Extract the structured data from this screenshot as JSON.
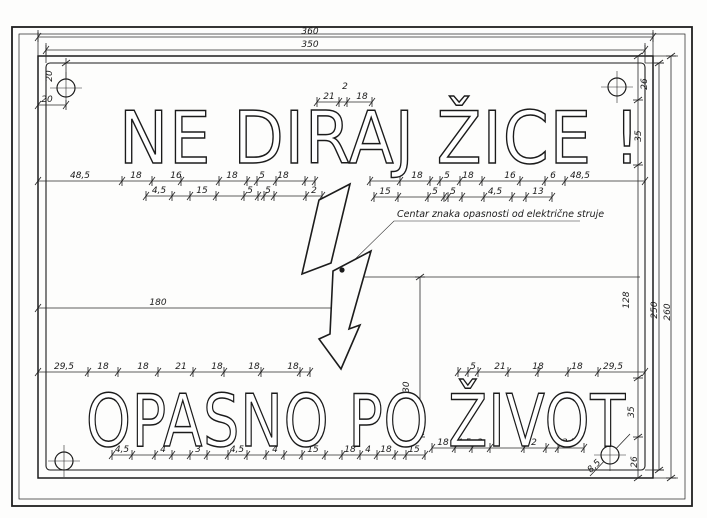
{
  "sign": {
    "line1": "NE DIRAJ ŽICE !",
    "line2": "OPASNO PO ŽIVOT"
  },
  "annotation": {
    "text": "Centar znaka opasnosti od električne struje"
  },
  "features": {
    "symbol": "lightning-bolt",
    "mounting_holes": 4
  },
  "colors": {
    "ink": "#1c1c1c",
    "paper": "#fdfdfc"
  },
  "dim_labels": [
    {
      "t": "360",
      "x": 310,
      "y": 34,
      "r": 0
    },
    {
      "t": "350",
      "x": 310,
      "y": 47,
      "r": 0
    },
    {
      "t": "20",
      "x": 52,
      "y": 76,
      "r": -90
    },
    {
      "t": "20",
      "x": 47,
      "y": 102,
      "r": 0
    },
    {
      "t": "26",
      "x": 647,
      "y": 84,
      "r": -90
    },
    {
      "t": "35",
      "x": 641,
      "y": 136,
      "r": -90
    },
    {
      "t": "21",
      "x": 329,
      "y": 99,
      "r": 0
    },
    {
      "t": "2",
      "x": 345,
      "y": 89,
      "r": 0
    },
    {
      "t": "18",
      "x": 362,
      "y": 99,
      "r": 0
    },
    {
      "t": "48,5",
      "x": 80,
      "y": 178,
      "r": 0
    },
    {
      "t": "18",
      "x": 136,
      "y": 178,
      "r": 0
    },
    {
      "t": "16",
      "x": 176,
      "y": 178,
      "r": 0
    },
    {
      "t": "18",
      "x": 232,
      "y": 178,
      "r": 0
    },
    {
      "t": "5",
      "x": 262,
      "y": 178,
      "r": 0
    },
    {
      "t": "18",
      "x": 283,
      "y": 178,
      "r": 0
    },
    {
      "t": "18",
      "x": 417,
      "y": 178,
      "r": 0
    },
    {
      "t": "5",
      "x": 447,
      "y": 178,
      "r": 0
    },
    {
      "t": "18",
      "x": 468,
      "y": 178,
      "r": 0
    },
    {
      "t": "16",
      "x": 510,
      "y": 178,
      "r": 0
    },
    {
      "t": "6",
      "x": 553,
      "y": 178,
      "r": 0
    },
    {
      "t": "48,5",
      "x": 580,
      "y": 178,
      "r": 0
    },
    {
      "t": "4,5",
      "x": 159,
      "y": 193,
      "r": 0
    },
    {
      "t": "15",
      "x": 202,
      "y": 193,
      "r": 0
    },
    {
      "t": "5",
      "x": 250,
      "y": 193,
      "r": 0
    },
    {
      "t": "5",
      "x": 268,
      "y": 193,
      "r": 0
    },
    {
      "t": "2",
      "x": 314,
      "y": 193,
      "r": 0
    },
    {
      "t": "15",
      "x": 385,
      "y": 194,
      "r": 0
    },
    {
      "t": "5",
      "x": 435,
      "y": 194,
      "r": 0
    },
    {
      "t": "5",
      "x": 453,
      "y": 194,
      "r": 0
    },
    {
      "t": "4,5",
      "x": 495,
      "y": 194,
      "r": 0
    },
    {
      "t": "13",
      "x": 538,
      "y": 194,
      "r": 0
    },
    {
      "t": "180",
      "x": 158,
      "y": 305,
      "r": 0
    },
    {
      "t": "130",
      "x": 409,
      "y": 390,
      "r": -90
    },
    {
      "t": "128",
      "x": 629,
      "y": 300,
      "r": -90
    },
    {
      "t": "250",
      "x": 657,
      "y": 310,
      "r": -90
    },
    {
      "t": "260",
      "x": 670,
      "y": 312,
      "r": -90
    },
    {
      "t": "29,5",
      "x": 64,
      "y": 369,
      "r": 0
    },
    {
      "t": "18",
      "x": 103,
      "y": 369,
      "r": 0
    },
    {
      "t": "18",
      "x": 143,
      "y": 369,
      "r": 0
    },
    {
      "t": "21",
      "x": 181,
      "y": 369,
      "r": 0
    },
    {
      "t": "18",
      "x": 217,
      "y": 369,
      "r": 0
    },
    {
      "t": "18",
      "x": 254,
      "y": 369,
      "r": 0
    },
    {
      "t": "18",
      "x": 293,
      "y": 369,
      "r": 0
    },
    {
      "t": "5",
      "x": 473,
      "y": 369,
      "r": 0
    },
    {
      "t": "21",
      "x": 500,
      "y": 369,
      "r": 0
    },
    {
      "t": "18",
      "x": 538,
      "y": 369,
      "r": 0
    },
    {
      "t": "18",
      "x": 577,
      "y": 369,
      "r": 0
    },
    {
      "t": "29,5",
      "x": 613,
      "y": 369,
      "r": 0
    },
    {
      "t": "4,5",
      "x": 122,
      "y": 452,
      "r": 0
    },
    {
      "t": "4",
      "x": 163,
      "y": 452,
      "r": 0
    },
    {
      "t": "3",
      "x": 198,
      "y": 452,
      "r": 0
    },
    {
      "t": "4,5",
      "x": 237,
      "y": 452,
      "r": 0
    },
    {
      "t": "4",
      "x": 275,
      "y": 452,
      "r": 0
    },
    {
      "t": "15",
      "x": 313,
      "y": 452,
      "r": 0
    },
    {
      "t": "18",
      "x": 350,
      "y": 452,
      "r": 0
    },
    {
      "t": "4",
      "x": 368,
      "y": 452,
      "r": 0
    },
    {
      "t": "18",
      "x": 386,
      "y": 452,
      "r": 0
    },
    {
      "t": "15",
      "x": 414,
      "y": 452,
      "r": 0
    },
    {
      "t": "18",
      "x": 443,
      "y": 445,
      "r": 0
    },
    {
      "t": "4,5",
      "x": 464,
      "y": 445,
      "r": 0
    },
    {
      "t": "3",
      "x": 480,
      "y": 445,
      "r": 0
    },
    {
      "t": "2",
      "x": 534,
      "y": 445,
      "r": 0
    },
    {
      "t": "3,5",
      "x": 569,
      "y": 445,
      "r": 0
    },
    {
      "t": "8,5",
      "x": 596,
      "y": 468,
      "r": -45
    },
    {
      "t": "26",
      "x": 637,
      "y": 462,
      "r": -90
    },
    {
      "t": "35",
      "x": 634,
      "y": 412,
      "r": -90
    }
  ],
  "ticks": {
    "h": [
      {
        "y": 37,
        "xs": [
          38,
          653
        ]
      },
      {
        "y": 50,
        "xs": [
          46,
          645
        ]
      },
      {
        "y": 102,
        "xs": [
          317,
          339,
          347,
          372
        ]
      },
      {
        "y": 105,
        "xs": [
          38,
          66
        ]
      },
      {
        "y": 181,
        "xs": [
          38,
          122,
          152,
          181,
          219,
          247,
          257,
          276,
          305,
          315,
          370,
          400,
          430,
          440,
          460,
          482,
          520,
          545,
          565,
          645
        ]
      },
      {
        "y": 196,
        "xs": [
          146,
          172,
          190,
          216,
          244,
          258,
          264,
          274,
          306,
          322
        ]
      },
      {
        "y": 197,
        "xs": [
          374,
          398,
          428,
          444,
          448,
          462,
          484,
          512,
          526,
          552
        ]
      },
      {
        "y": 308,
        "xs": [
          38,
          343
        ]
      },
      {
        "y": 372,
        "xs": [
          38,
          88,
          118,
          158,
          193,
          224,
          261,
          300,
          310,
          458,
          468,
          478,
          508,
          538,
          568,
          598,
          645
        ]
      },
      {
        "y": 455,
        "xs": [
          112,
          132,
          155,
          172,
          190,
          207,
          228,
          247,
          266,
          284,
          302,
          325,
          342,
          360,
          377,
          395,
          406,
          425
        ]
      },
      {
        "y": 448,
        "xs": [
          432,
          455,
          472,
          490,
          524,
          546,
          558,
          584
        ]
      }
    ],
    "v": [
      {
        "x": 66,
        "ys": [
          63,
          88
        ]
      },
      {
        "x": 420,
        "ys": [
          277,
          437
        ]
      },
      {
        "x": 638,
        "ys": [
          56,
          100,
          165,
          378,
          437,
          478
        ]
      },
      {
        "x": 659,
        "ys": [
          63,
          470
        ]
      },
      {
        "x": 671,
        "ys": [
          56,
          478
        ]
      }
    ]
  }
}
